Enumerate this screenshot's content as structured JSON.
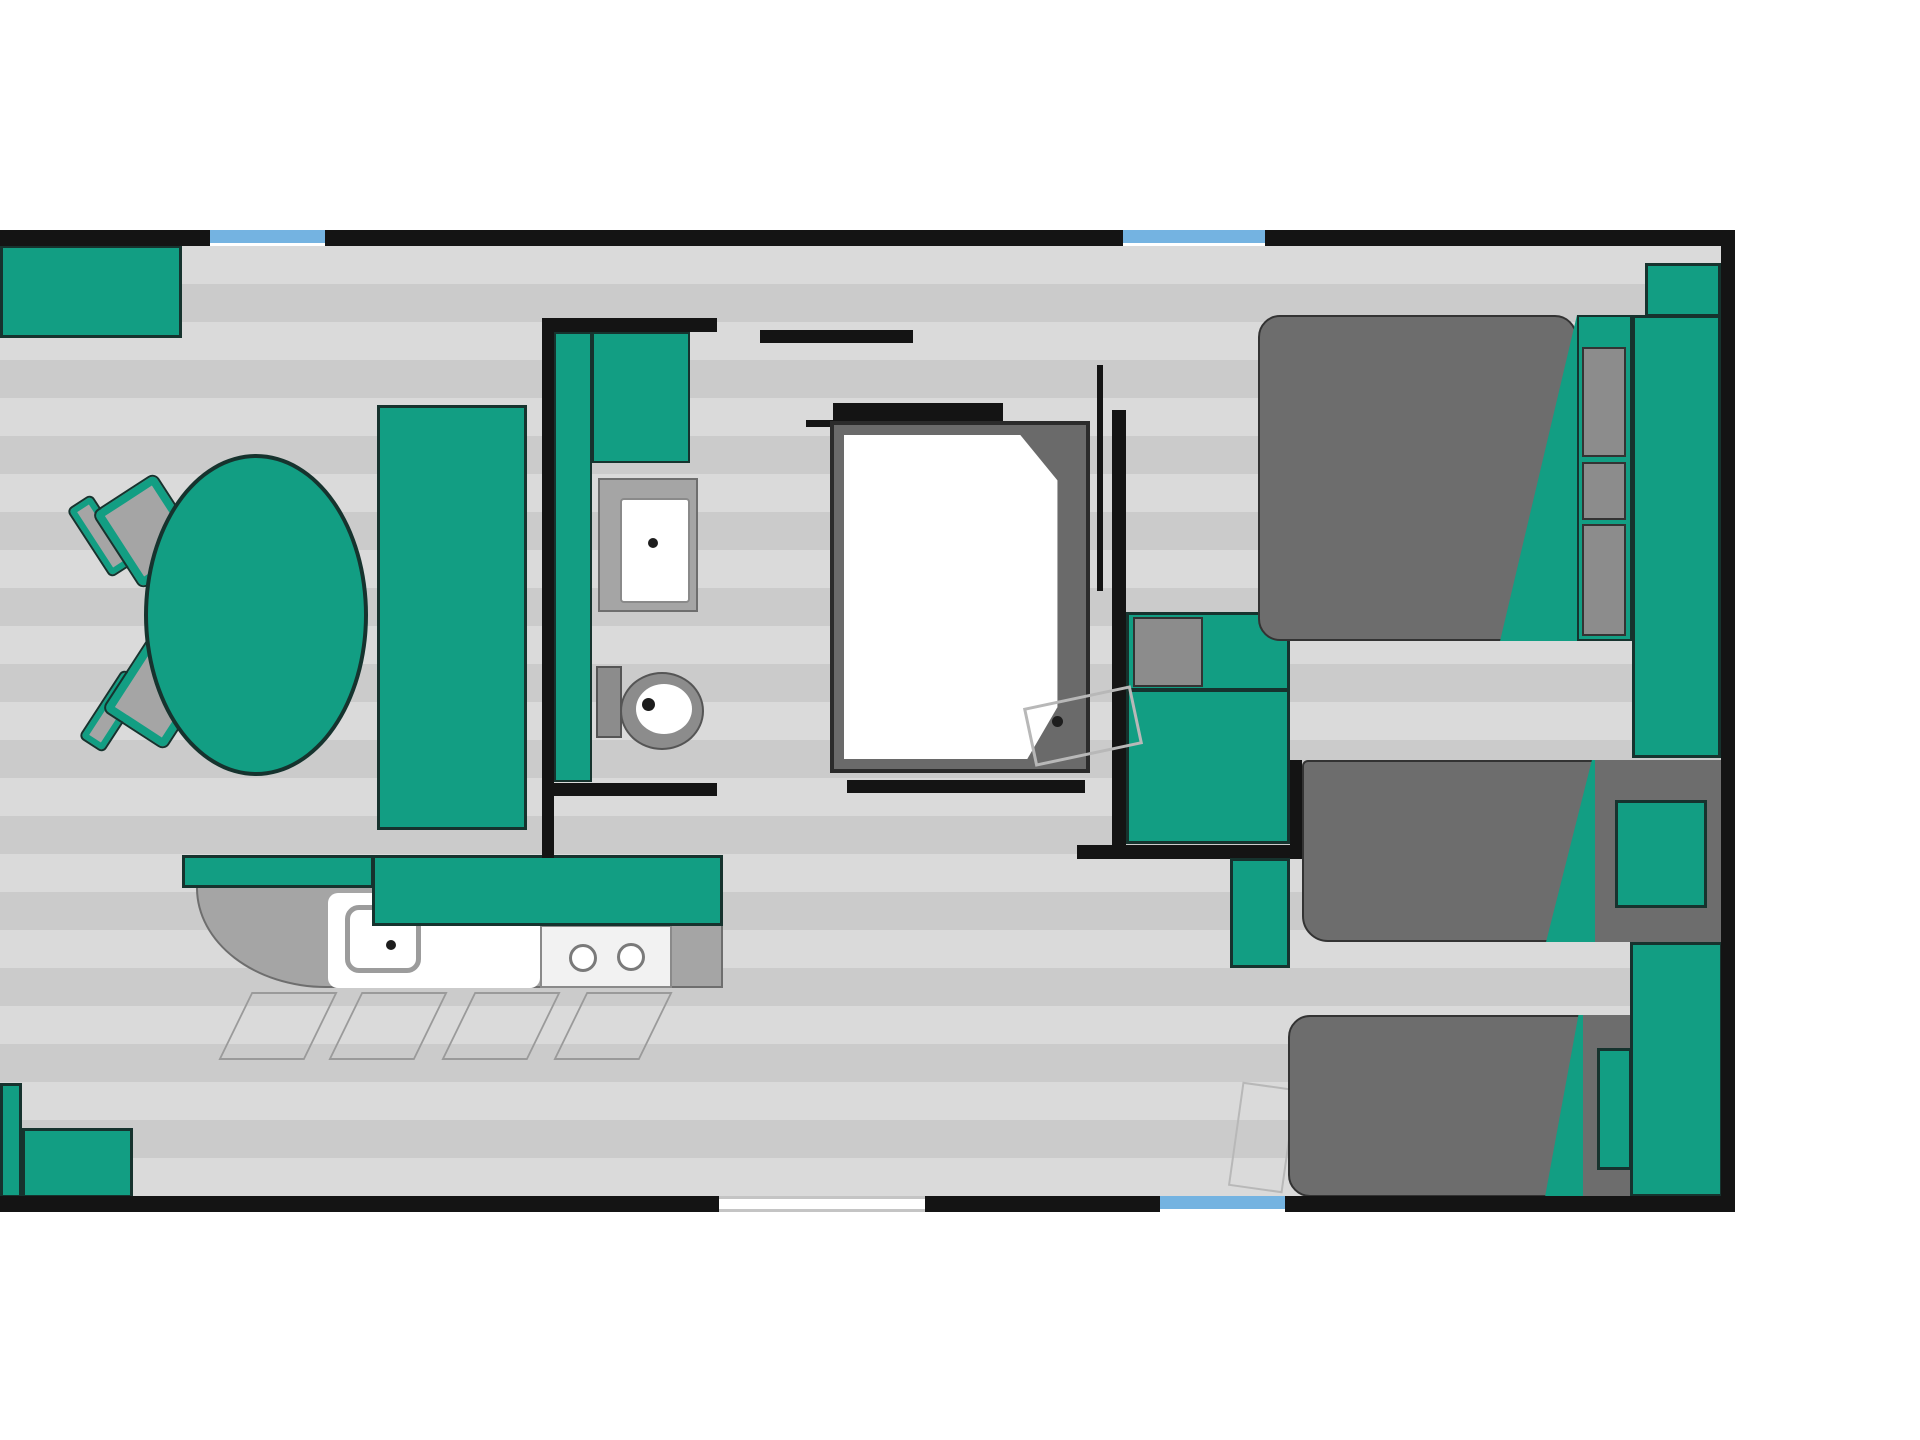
{
  "diagram": {
    "type": "floor-plan",
    "subject": "mobile-home / caravan layout, top-down view",
    "text_labels": [],
    "rooms": [
      {
        "name": "living-dining-area",
        "position": "left"
      },
      {
        "name": "kitchen",
        "position": "bottom-left"
      },
      {
        "name": "bathroom-wc",
        "position": "center-left"
      },
      {
        "name": "shower-room",
        "position": "center"
      },
      {
        "name": "master-bedroom",
        "position": "top-right"
      },
      {
        "name": "twin-bedroom",
        "position": "bottom-right"
      }
    ],
    "furniture": [
      {
        "name": "sofa",
        "room": "living-dining-area",
        "color": "teal"
      },
      {
        "name": "dining-table-oval",
        "room": "living-dining-area",
        "color": "teal"
      },
      {
        "name": "dining-chair",
        "count": 2,
        "room": "living-dining-area",
        "color": "gray-teal"
      },
      {
        "name": "bench-seat",
        "room": "living-dining-area",
        "color": "teal"
      },
      {
        "name": "kitchen-counter-with-sink-and-cooktop",
        "room": "kitchen",
        "burners": 2
      },
      {
        "name": "washbasin",
        "room": "bathroom-wc"
      },
      {
        "name": "toilet",
        "room": "bathroom-wc"
      },
      {
        "name": "vanity-cabinet",
        "room": "bathroom-wc",
        "color": "teal"
      },
      {
        "name": "shower-tray",
        "room": "shower-room"
      },
      {
        "name": "wardrobe-cabinets",
        "room": "corridor",
        "color": "teal"
      },
      {
        "name": "double-bed",
        "room": "master-bedroom",
        "mattress": "dark-gray",
        "headboard": "teal"
      },
      {
        "name": "single-bed",
        "count": 2,
        "room": "twin-bedroom",
        "mattress": "dark-gray",
        "pillow": "teal"
      },
      {
        "name": "nightstand-column",
        "room": "twin-bedroom",
        "color": "teal"
      },
      {
        "name": "entry-steps",
        "room": "exterior",
        "color": "teal"
      }
    ],
    "openings": [
      {
        "name": "window",
        "count": 2,
        "wall": "top",
        "color": "light-blue"
      },
      {
        "name": "window",
        "count": 1,
        "wall": "bottom",
        "color": "light-blue"
      },
      {
        "name": "entry-door-gap",
        "wall": "bottom"
      }
    ]
  },
  "palette": {
    "teal": "#129E83",
    "teal-dark": "#16332E",
    "wall": "#141414",
    "floor-light": "#DADADA",
    "floor-dark": "#CBCBCB",
    "gray-counter": "#A5A5A5",
    "gray-dark": "#8C8C8C",
    "mattress": "#6D6D6D",
    "window-blue": "#74B3E1",
    "leaf": "#B8B8B8",
    "white": "#FFFFFF",
    "dot": "#1D1D1D"
  }
}
